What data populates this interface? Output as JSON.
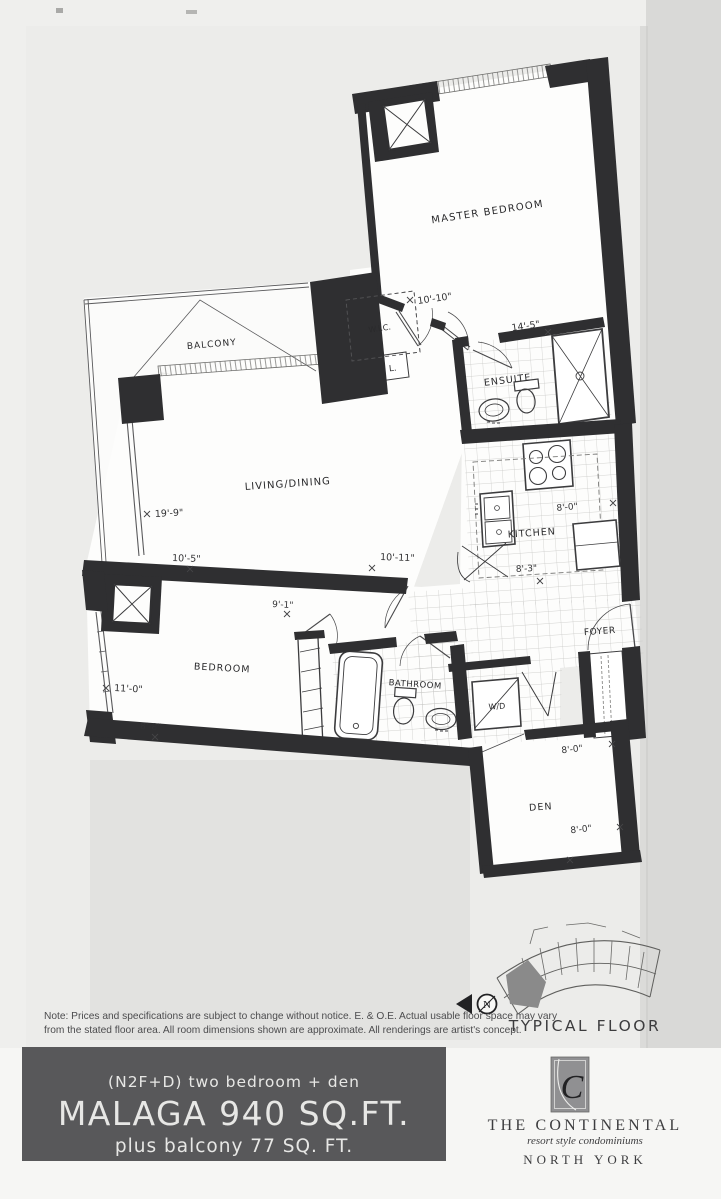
{
  "plan": {
    "rooms": {
      "master_bedroom": "MASTER BEDROOM",
      "balcony": "BALCONY",
      "living_dining": "LIVING/DINING",
      "wic": "W.I.C.",
      "linen": "L.",
      "ensuite": "ENSUITE",
      "kitchen": "KITCHEN",
      "foyer": "FOYER",
      "bedroom": "BEDROOM",
      "bathroom": "BATHROOM",
      "washer_dryer": "W/D",
      "den": "DEN"
    },
    "dimensions": {
      "master_width": "10'-10\"",
      "master_length": "14'-5\"",
      "living_length": "19'-9\"",
      "living_width": "10'-5\"",
      "living_width2": "10'-11\"",
      "hall_width": "9'-1\"",
      "bedroom_length": "11'-0\"",
      "bedroom_width": "8'-8\"",
      "kitchen_width": "8'-0\"",
      "kitchen_length": "8'-3\"",
      "den_width": "8'-0\"",
      "den_length": "8'-0\""
    },
    "compass": "N",
    "keyplan_caption": "TYPICAL FLOOR"
  },
  "note": {
    "line1": "Note: Prices and specifications are subject to change without notice. E. & O.E. Actual usable floor space may vary",
    "line2": "from the stated floor area. All room dimensions shown are approximate. All renderings are artist's concept."
  },
  "footer": {
    "unit_code": "(N2F+D)",
    "unit_type": "two bedroom + den",
    "title": "MALAGA 940 SQ.FT.",
    "balcony": "plus balcony 77 SQ. FT."
  },
  "brand": {
    "monogram": "C",
    "name": "THE CONTINENTAL",
    "tagline": "resort style condominiums",
    "city": "NORTH YORK"
  },
  "colors": {
    "wall": "#2f2f31",
    "footer_bg": "#58585a",
    "footer_text": "#e7e7e5",
    "logo_gray": "#909092",
    "highlight_unit": "#8a8a8a"
  }
}
